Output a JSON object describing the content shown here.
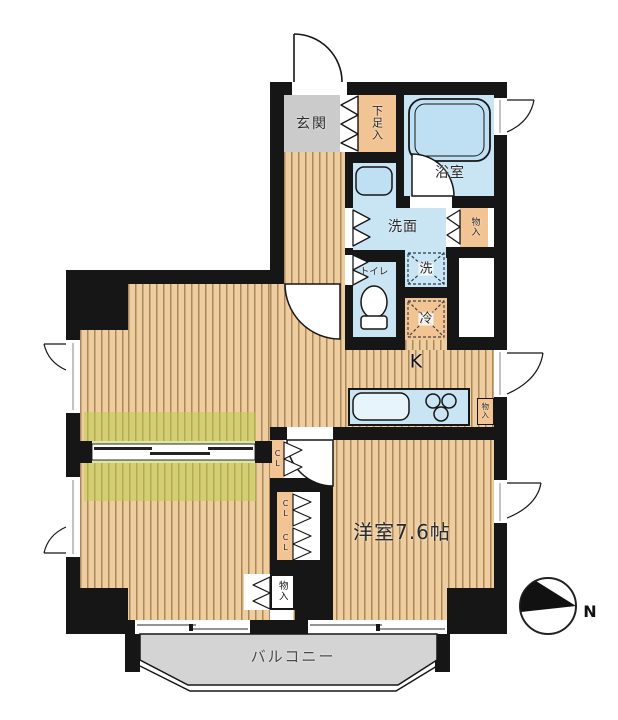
{
  "labels": {
    "genkan": "玄関",
    "shoe_cabinet": "下足入",
    "bathroom": "浴室",
    "washroom": "洗面",
    "washroom_storage": "物入",
    "toilet": "トイレ",
    "laundry_space": "洗",
    "refrigerator_space": "冷",
    "kitchen": "K",
    "kitchen_storage": "物入",
    "closet_top": "CL",
    "closet_mid_upper": "CL",
    "closet_mid_lower": "CL",
    "bottom_storage": "物入",
    "western_room": "洋室7.6帖",
    "balcony": "バルコニー",
    "compass_north": "N"
  },
  "colors": {
    "wall": "#161616",
    "wood_floor": "#eecd9e",
    "wet_area_blue": "#c9e4f3",
    "storage_tan": "#f3c493",
    "entry_gray": "#cbcbcb",
    "balcony_gray": "#d4d4d4",
    "partition_highlight": "#b7d048"
  }
}
